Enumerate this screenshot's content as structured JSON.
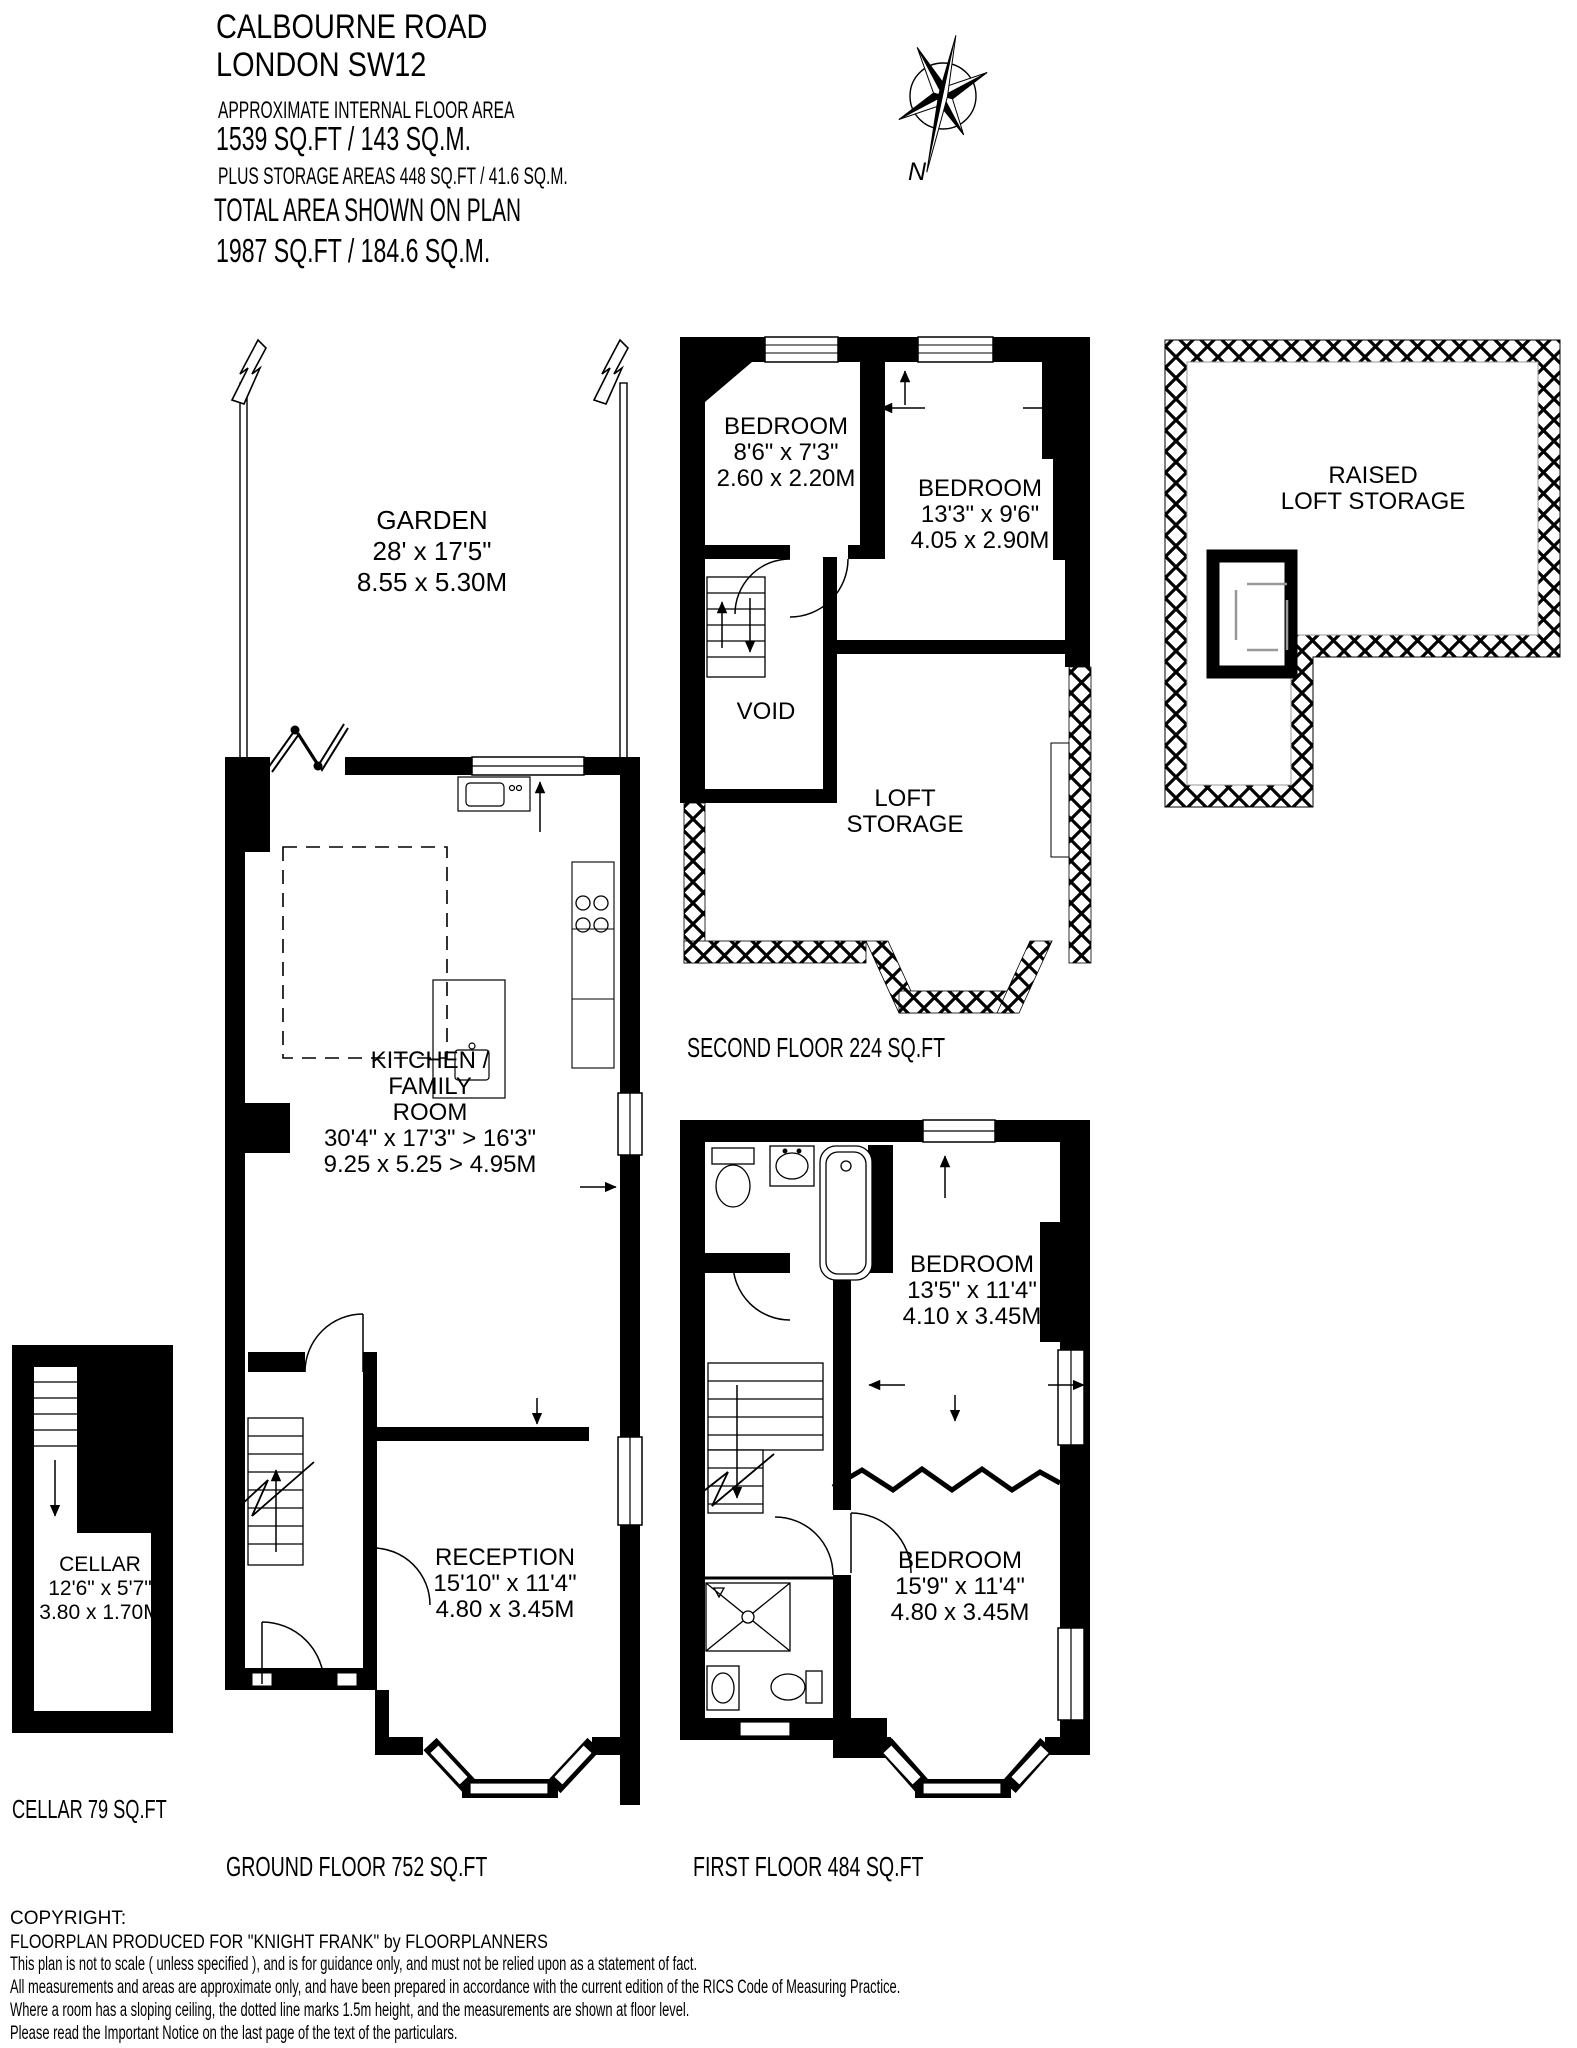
{
  "header": {
    "title_line1": "CALBOURNE ROAD",
    "title_line2": "LONDON SW12",
    "approx_label": "APPROXIMATE INTERNAL FLOOR AREA",
    "approx_area": "1539 SQ.FT / 143 SQ.M.",
    "storage_note": "PLUS STORAGE AREAS 448 SQ.FT / 41.6 SQ.M.",
    "total_label": "TOTAL AREA SHOWN ON PLAN",
    "total_area": "1987 SQ.FT / 184.6 SQ.M."
  },
  "compass": {
    "north_label": "N"
  },
  "rooms": {
    "garden": {
      "name": "GARDEN",
      "dims_ft": "28' x 17'5\"",
      "dims_m": "8.55 x 5.30M"
    },
    "kitchen": {
      "name_line1": "KITCHEN /",
      "name_line2": "FAMILY",
      "name_line3": "ROOM",
      "dims_ft": "30'4\" x 17'3\" > 16'3\"",
      "dims_m": "9.25 x 5.25 > 4.95M"
    },
    "reception": {
      "name": "RECEPTION",
      "dims_ft": "15'10\" x 11'4\"",
      "dims_m": "4.80 x 3.45M"
    },
    "cellar": {
      "name": "CELLAR",
      "dims_ft": "12'6\" x 5'7\"",
      "dims_m": "3.80 x 1.70M"
    },
    "bedroom_second_small": {
      "name": "BEDROOM",
      "dims_ft": "8'6\" x 7'3\"",
      "dims_m": "2.60 x 2.20M"
    },
    "bedroom_second_large": {
      "name": "BEDROOM",
      "dims_ft": "13'3\" x 9'6\"",
      "dims_m": "4.05 x 2.90M"
    },
    "void": {
      "name": "VOID"
    },
    "loft_storage": {
      "line1": "LOFT",
      "line2": "STORAGE"
    },
    "raised_loft_storage": {
      "line1": "RAISED",
      "line2": "LOFT STORAGE"
    },
    "bedroom_first_rear": {
      "name": "BEDROOM",
      "dims_ft": "13'5\" x 11'4\"",
      "dims_m": "4.10 x 3.45M"
    },
    "bedroom_first_front": {
      "name": "BEDROOM",
      "dims_ft": "15'9\" x 11'4\"",
      "dims_m": "4.80 x 3.45M"
    }
  },
  "floor_captions": {
    "cellar": "CELLAR 79 SQ.FT",
    "ground": "GROUND FLOOR 752 SQ.FT",
    "first": "FIRST FLOOR 484 SQ.FT",
    "second": "SECOND FLOOR 224 SQ.FT"
  },
  "copyright": {
    "line1": "COPYRIGHT:",
    "line2": " FLOORPLAN PRODUCED FOR \"KNIGHT FRANK\" by FLOORPLANNERS",
    "line3": "This plan is not to scale  ( unless specified ), and is for guidance only, and must not be relied upon as a statement of fact.",
    "line4": "All measurements and areas are approximate only, and have been prepared in accordance with the current edition of the RICS Code of Measuring Practice.",
    "line5": "Where a room has a sloping ceiling, the dotted line marks 1.5m height, and the measurements are shown at floor level.",
    "line6": "Please read the Important Notice on the last page of the text of the particulars."
  },
  "colors": {
    "wall": "#000000",
    "paper": "#ffffff"
  }
}
